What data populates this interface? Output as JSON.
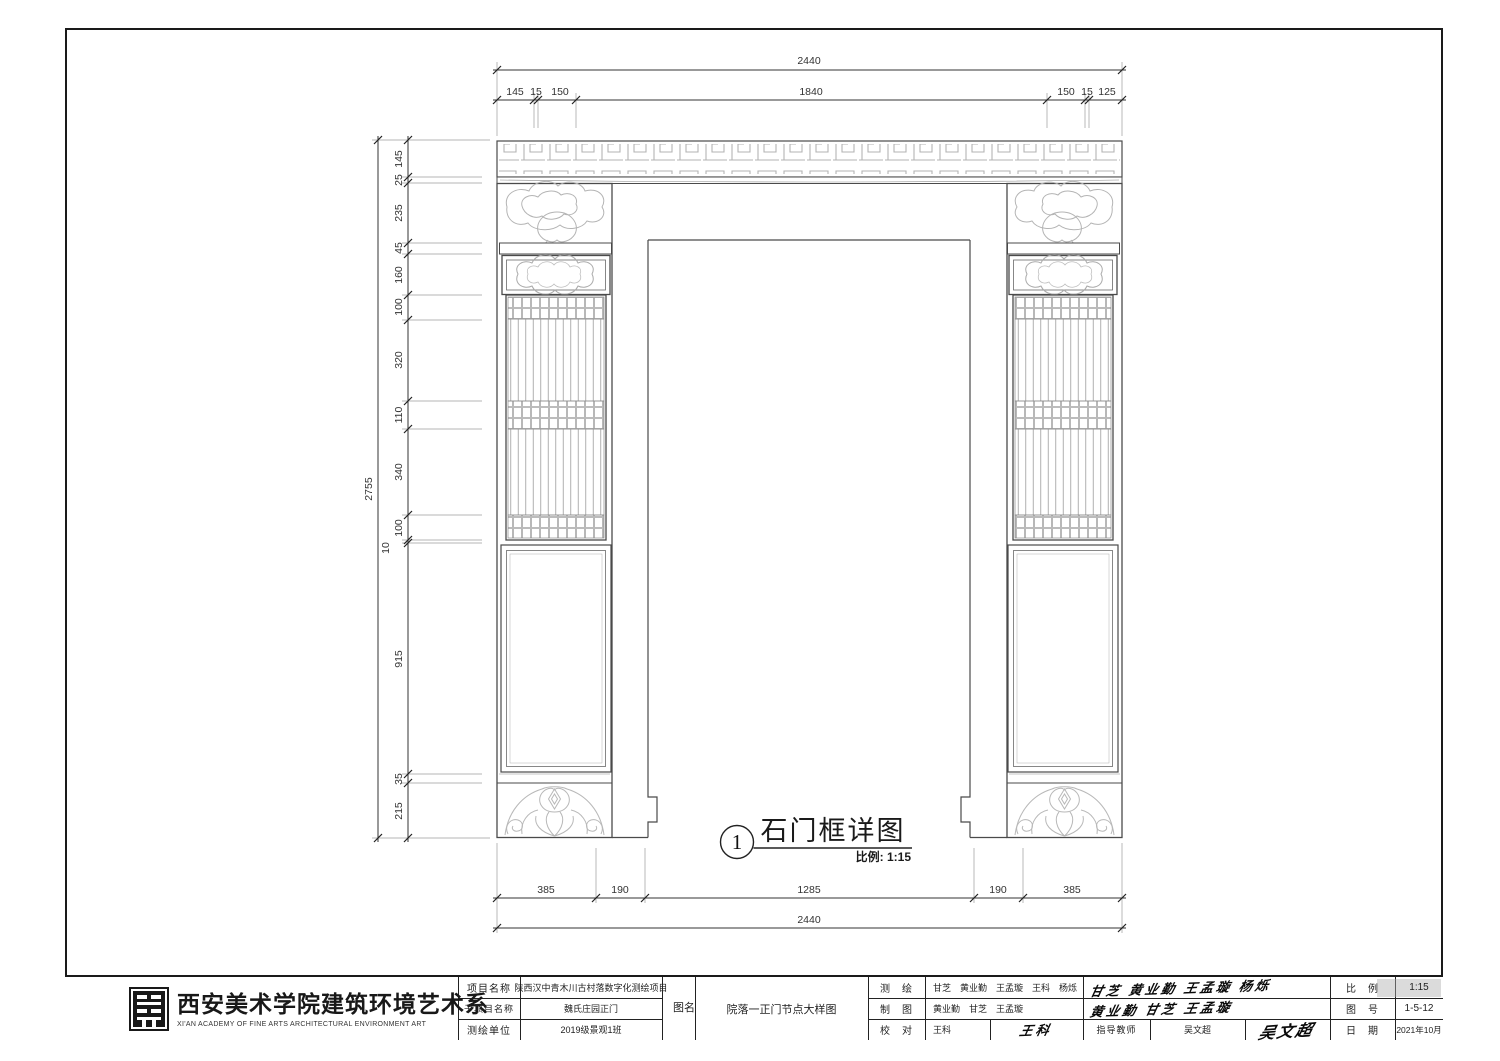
{
  "sheet": {
    "detail": {
      "number": "1",
      "title": "石门框详图",
      "scale_note": "比例: 1:15"
    },
    "dimensions": {
      "top_overall": "2440",
      "top_segments": [
        "145",
        "15",
        "150",
        "1840",
        "150",
        "15",
        "125"
      ],
      "left_overall": "2755",
      "left_segments": [
        "145",
        "25",
        "235",
        "45",
        "160",
        "100",
        "320",
        "110",
        "340",
        "100",
        "10",
        "915",
        "35",
        "215"
      ],
      "bottom_segments": [
        "385",
        "190",
        "1285",
        "190",
        "385"
      ],
      "bottom_overall": "2440"
    }
  },
  "title_block": {
    "org": {
      "cn": "西安美术学院建筑环境艺术系",
      "en": "XI'AN ACADEMY OF FINE ARTS ARCHITECTURAL ENVIRONMENT ART"
    },
    "project": {
      "label": "项目名称",
      "value": "陕西汉中青木川古村落数字化测绘项目"
    },
    "subproject": {
      "label": "子项目名称",
      "value": "魏氏庄园正门"
    },
    "survey_unit": {
      "label": "测绘单位",
      "value": "2019级景观1班"
    },
    "drawing_name": {
      "label": "图名",
      "value": "院落一正门节点大样图"
    },
    "survey": {
      "label": "测　绘",
      "value": "甘芝　黄业勤　王孟璇　王科　杨烁",
      "signature": "甘芝 黄业勤 王孟璇 杨烁"
    },
    "draft": {
      "label": "制　图",
      "value": "黄业勤　甘芝　王孟璇",
      "signature": "黄业勤 甘芝 王孟璇"
    },
    "check": {
      "label": "校　对",
      "value": "王科",
      "signature": "王科"
    },
    "advisor": {
      "label": "指导教师",
      "value": "吴文超",
      "signature": "吴文超"
    },
    "scale": {
      "label": "比　例",
      "value": "1:15"
    },
    "sheet_no": {
      "label": "图　号",
      "value": "1-5-12"
    },
    "date": {
      "label": "日　期",
      "value": "2021年10月"
    }
  }
}
